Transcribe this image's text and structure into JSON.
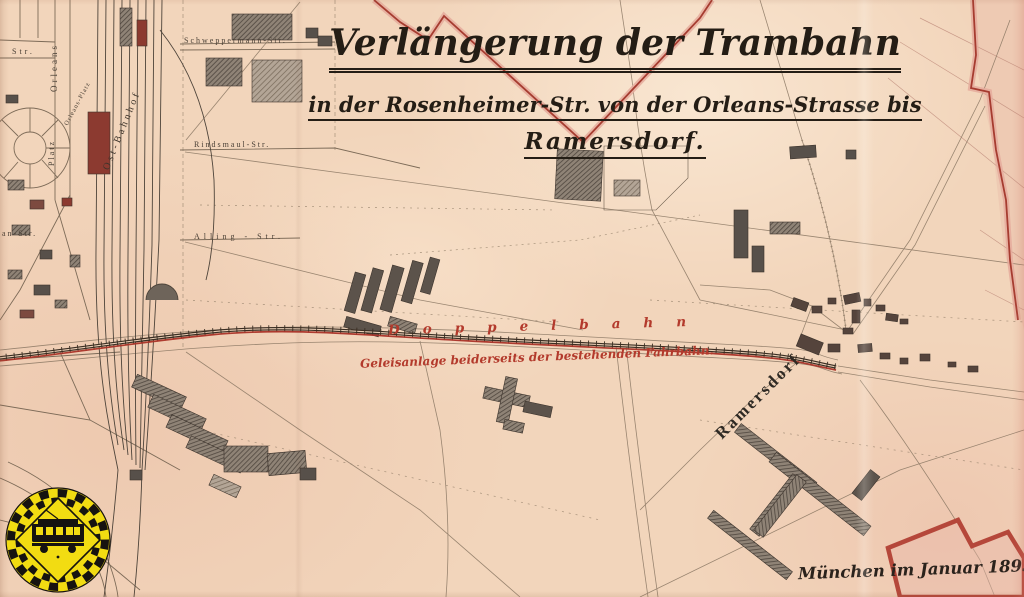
{
  "map": {
    "title": {
      "line1": "Verlängerung der Trambahn",
      "line2": "in der Rosenheimer-Str. von der Orleans-Strasse bis",
      "line3": "Ramersdorf."
    },
    "annotations": {
      "track_label": "Doppelbahn",
      "track_note": "Geleisanlage beiderseits der bestehenden Fahrbahn.",
      "date_note": "München im Januar 1895."
    },
    "places": {
      "village": "Ramersdorf",
      "station": "Ost-Bahnhof"
    },
    "streets": {
      "schweppermann": "Schweppermann-Str.",
      "rindsmaul": "Rindsmaul-Str.",
      "alling": "Alling - Str.",
      "orleans": "Orleans",
      "platz": "Platz",
      "orleans_platz": "Orleans-Platz",
      "str_fragment": "Str.",
      "an_str_fragment": "an-Str."
    },
    "colors": {
      "paper": "#f2d5bb",
      "ink": "#241d15",
      "map_line": "#8a7763",
      "red_annotation": "#b33a2c",
      "boundary_red": "#a63c30",
      "logo_yellow": "#f2dc12"
    }
  }
}
